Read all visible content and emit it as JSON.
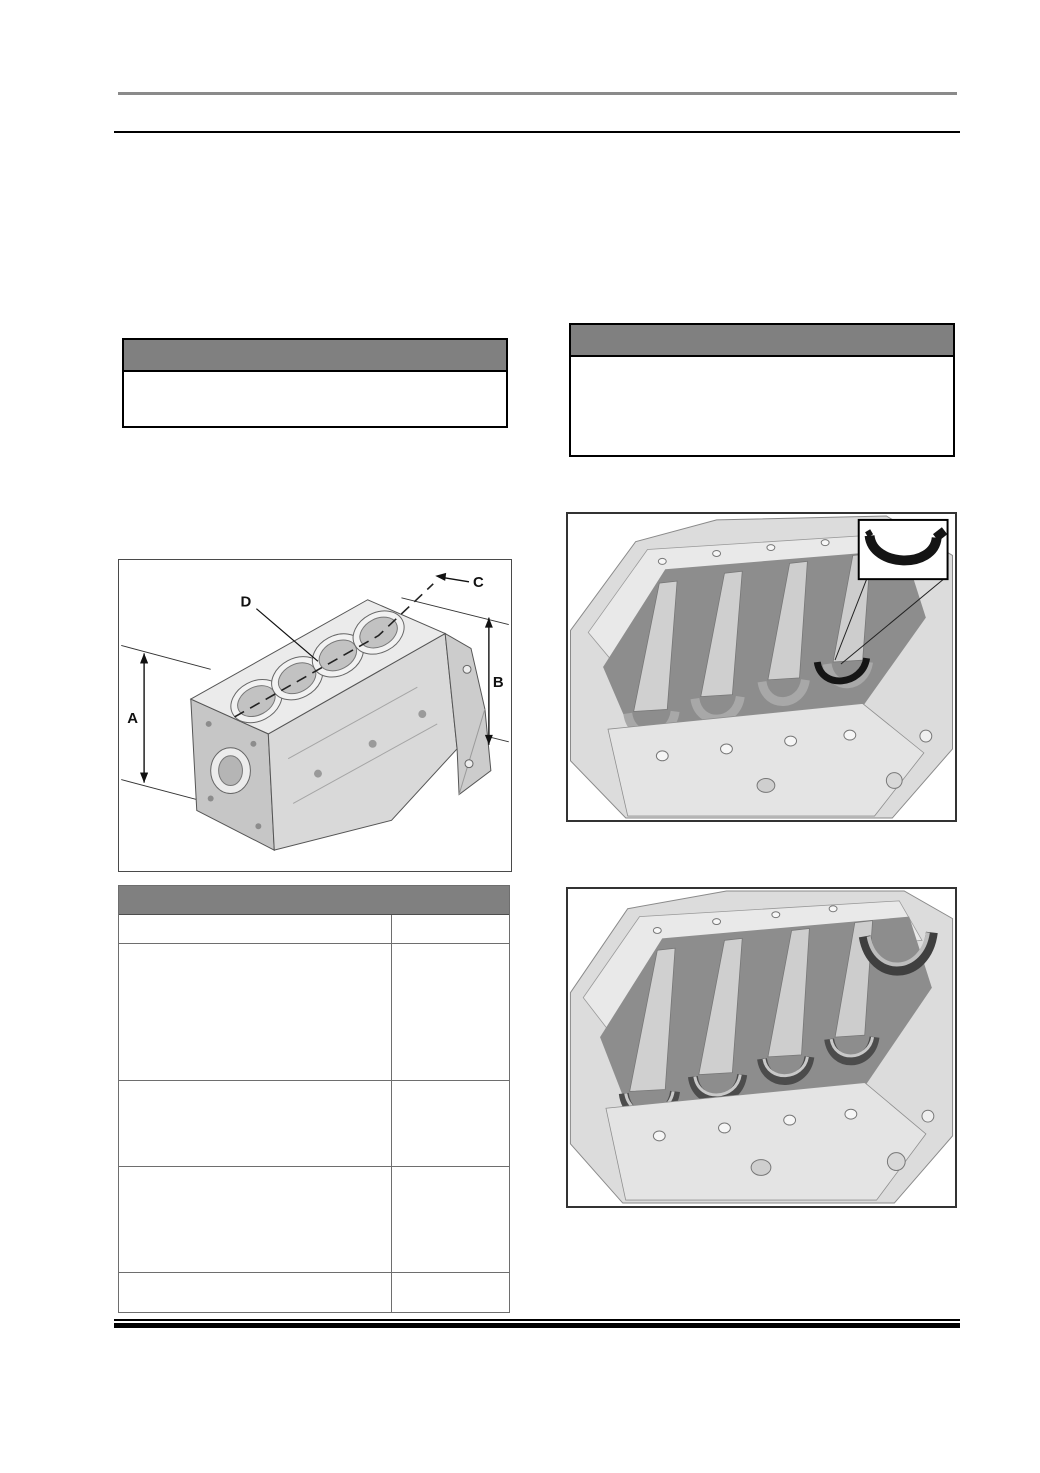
{
  "page_type": "engine-service-manual-page",
  "colors": {
    "band_gray": "#808080",
    "top_rule_gray": "#8a8a8a",
    "rule_black": "#000000",
    "table_border": "#6e6e6e"
  },
  "notices": {
    "left": {
      "title": "",
      "body": ""
    },
    "right": {
      "title": "",
      "body": ""
    }
  },
  "diagram": {
    "description_icon": "engine-block-isometric-drawing",
    "dimension_labels": {
      "a": "A",
      "b": "B",
      "c": "C",
      "d": "D"
    }
  },
  "spec_table": {
    "title": "",
    "col_header": {
      "description": "",
      "value": ""
    },
    "rows": [
      {
        "description": "",
        "value": ""
      },
      {
        "description": "",
        "value": ""
      },
      {
        "description": "",
        "value": ""
      },
      {
        "description": "",
        "value": ""
      }
    ]
  },
  "photos": {
    "top": {
      "content_icon": "crankcase-bottom-view-with-thrust-washer-callout",
      "inset_icon": "thrust-washer-crescent"
    },
    "bottom": {
      "content_icon": "crankcase-bottom-view-bearing-shells"
    }
  }
}
